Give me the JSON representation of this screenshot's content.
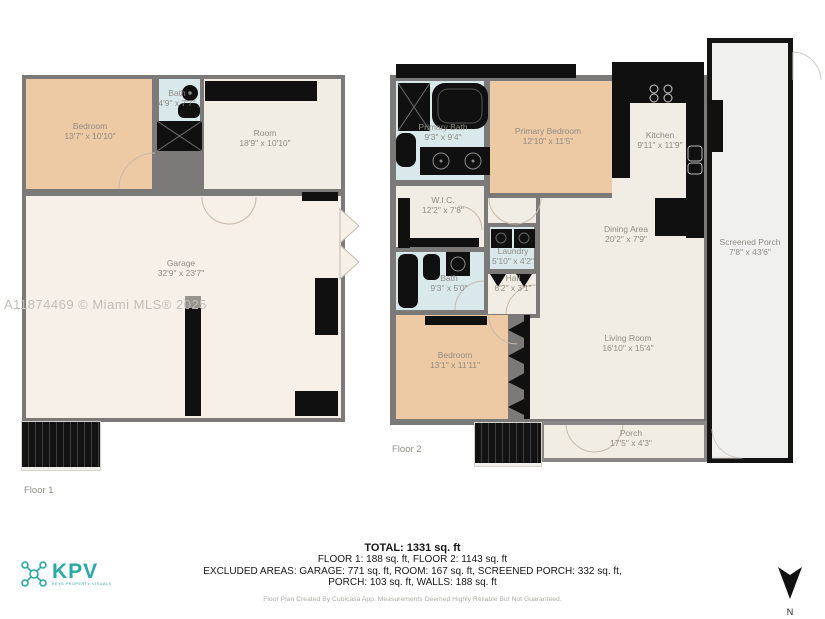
{
  "watermark": "A11874469 © Miami MLS® 2025",
  "floor1": {
    "label": "Floor 1",
    "rooms": {
      "bedroom": {
        "name": "Bedroom",
        "dims": "13'7\" x 10'10\""
      },
      "bath": {
        "name": "Bath",
        "dims": "4'9\" x 7'7\""
      },
      "room": {
        "name": "Room",
        "dims": "18'9\" x 10'10\""
      },
      "garage": {
        "name": "Garage",
        "dims": "32'9\" x 23'7\""
      }
    }
  },
  "floor2": {
    "label": "Floor 2",
    "rooms": {
      "primary_bath": {
        "name": "Primary Bath",
        "dims": "9'3\" x 9'4\""
      },
      "primary_bedroom": {
        "name": "Primary Bedroom",
        "dims": "12'10\" x 11'5\""
      },
      "kitchen": {
        "name": "Kitchen",
        "dims": "9'11\" x 11'9\""
      },
      "wic": {
        "name": "W.I.C.",
        "dims": "12'2\" x 7'8\""
      },
      "laundry": {
        "name": "Laundry",
        "dims": "5'10\" x 4'2\""
      },
      "dining": {
        "name": "Dining Area",
        "dims": "20'2\" x 7'9\""
      },
      "bath": {
        "name": "Bath",
        "dims": "9'3\" x 5'0\""
      },
      "hall": {
        "name": "Hall",
        "dims": "6'2\" x 3'1\""
      },
      "bedroom": {
        "name": "Bedroom",
        "dims": "13'1\" x 11'11\""
      },
      "living": {
        "name": "Living Room",
        "dims": "16'10\" x 15'4\""
      },
      "porch": {
        "name": "Porch",
        "dims": "17'5\" x 4'3\""
      },
      "screened_porch": {
        "name": "Screened Porch",
        "dims": "7'8\" x 43'6\""
      }
    }
  },
  "summary": {
    "total": "TOTAL: 1331 sq. ft",
    "floors": "FLOOR 1: 188 sq. ft, FLOOR 2: 1143 sq. ft",
    "excluded1": "EXCLUDED AREAS: GARAGE: 771 sq. ft, ROOM: 167 sq. ft, SCREENED PORCH: 332 sq. ft,",
    "excluded2": "PORCH: 103 sq. ft, WALLS: 188 sq. ft",
    "credit": "Floor Plan Created By Cubicasa App. Measurements Deemed Highly Reliable But Not Guaranteed."
  },
  "logo": {
    "text": "KPV",
    "tagline": "KEYS PROPERTY VISUALS"
  },
  "compass": {
    "label": "N"
  },
  "colors": {
    "wall": "#7b7a78",
    "bedroom_fill": "#edc9a4",
    "wet_room_fill": "#d9e8ea",
    "room_fill": "#f2ede4",
    "fixture": "#101010",
    "logo_teal": "#2ba9a3"
  }
}
